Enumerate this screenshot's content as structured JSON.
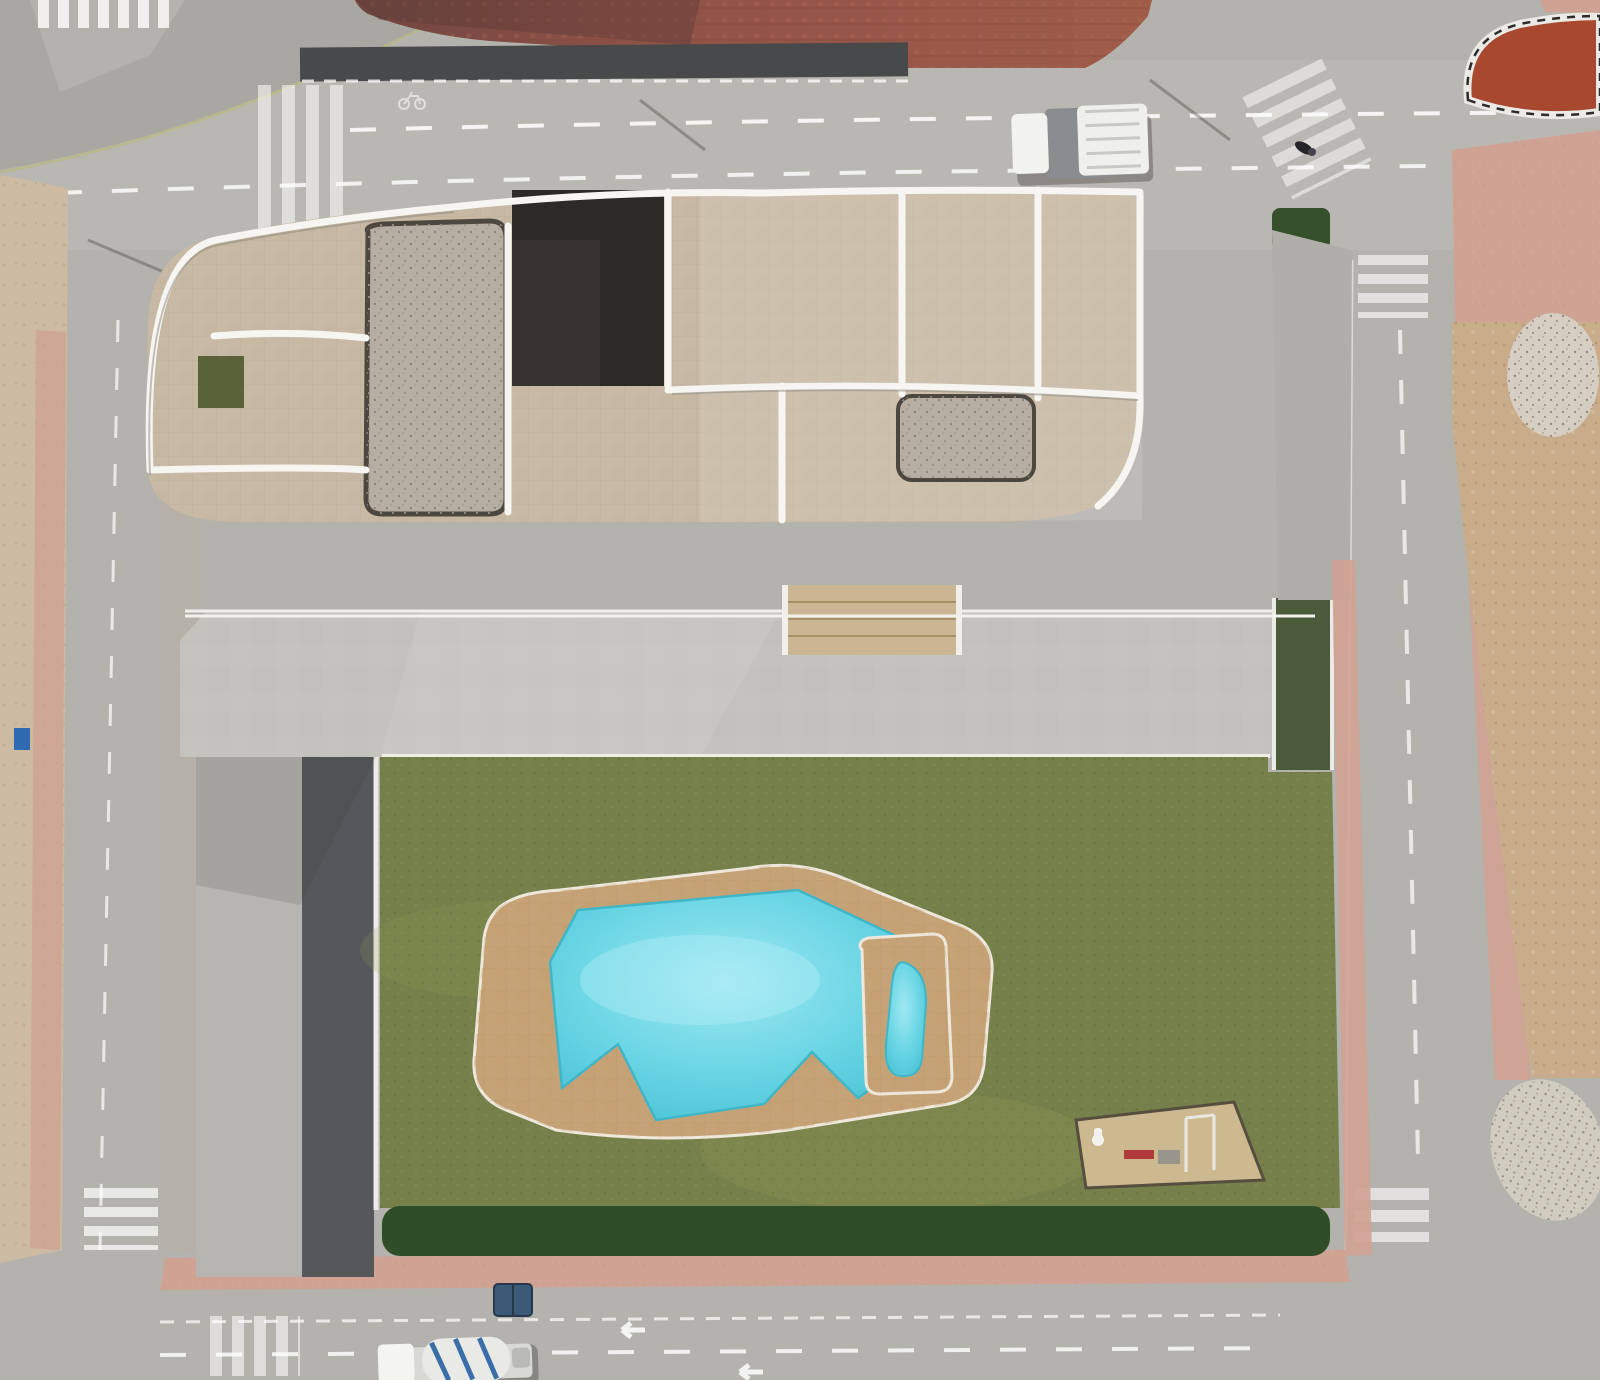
{
  "markings": {
    "stop": "STOP"
  },
  "colors": {
    "road": "#b4b2ad",
    "road_light": "#bdbbb5",
    "sidewalk": "#a9a7a1",
    "plaza": "#99574a",
    "plaza_dark": "#6f4641",
    "island": "#a8492f",
    "pink_sidewalk": "#cfa293",
    "sand": "#cdbaa3",
    "dirt": "#c9ad8b",
    "lawn": "#76804a",
    "turf": "#565d3c",
    "deck": "#c4c2bc",
    "parking_asphalt": "#55575a",
    "building_tile": "#c7b9a3",
    "gravel_roof": "#b6aea2",
    "dark_roof": "#37342f",
    "parapet": "#f6f5f2",
    "pool_water": "#5ecfdf",
    "pool_water_light": "#9fe9f2",
    "pool_deck": "#c6a376",
    "wood": "#a97c50",
    "hedge": "#2f4d26",
    "palm_light": "#c9cf86",
    "palm_dark": "#6b7a3e",
    "stall_line": "#e9e8e4",
    "car_glass": "#20262b"
  },
  "trees": {
    "palms": [
      [
        455,
        790,
        60
      ],
      [
        545,
        772,
        46
      ],
      [
        650,
        806,
        36
      ],
      [
        1080,
        815,
        52
      ],
      [
        1168,
        788,
        40
      ],
      [
        1300,
        858,
        42
      ],
      [
        405,
        935,
        40
      ],
      [
        458,
        1090,
        42
      ],
      [
        398,
        1175,
        36
      ],
      [
        700,
        1208,
        46
      ],
      [
        1135,
        1180,
        44
      ],
      [
        1336,
        1108,
        52
      ],
      [
        1352,
        1190,
        38
      ],
      [
        982,
        1228,
        34
      ],
      [
        845,
        800,
        26
      ],
      [
        995,
        806,
        28
      ],
      [
        58,
        1150,
        34
      ],
      [
        1500,
        172,
        40
      ],
      [
        1352,
        680,
        34
      ],
      [
        1560,
        1288,
        36
      ],
      [
        1035,
        165,
        20
      ],
      [
        905,
        745,
        24
      ]
    ],
    "bushes": [
      [
        402,
        862,
        28
      ],
      [
        368,
        906,
        20
      ],
      [
        530,
        786,
        24
      ],
      [
        614,
        794,
        22
      ],
      [
        852,
        804,
        20
      ],
      [
        968,
        810,
        22
      ],
      [
        1032,
        792,
        24
      ],
      [
        472,
        1122,
        28
      ],
      [
        522,
        1158,
        24
      ],
      [
        446,
        1128,
        26
      ],
      [
        952,
        1122,
        28
      ],
      [
        1002,
        1162,
        24
      ],
      [
        1046,
        1192,
        22
      ],
      [
        1298,
        640,
        18
      ],
      [
        1306,
        732,
        16
      ],
      [
        1298,
        902,
        20
      ],
      [
        1294,
        1002,
        18
      ],
      [
        25,
        652,
        12
      ],
      [
        20,
        782,
        10
      ],
      [
        35,
        1108,
        12
      ],
      [
        1468,
        432,
        8
      ],
      [
        1512,
        522,
        10
      ],
      [
        1480,
        642,
        9
      ],
      [
        1522,
        762,
        11
      ],
      [
        1494,
        902,
        10
      ],
      [
        1540,
        982,
        9
      ],
      [
        1472,
        1010,
        8
      ]
    ]
  },
  "hedge": {
    "x1": 398,
    "x2": 1318,
    "y": 1228,
    "step": 50,
    "r": 25
  },
  "sails": [
    [
      292,
      254,
      66,
      38
    ],
    [
      223,
      445,
      50,
      33
    ],
    [
      586,
      468,
      50,
      40
    ],
    [
      711,
      479,
      52,
      36
    ],
    [
      760,
      290,
      72,
      40
    ],
    [
      870,
      425,
      52,
      44
    ],
    [
      1122,
      256,
      58,
      38
    ],
    [
      1237,
      427,
      60,
      40
    ]
  ],
  "skylights": [
    [
      352,
      404
    ],
    [
      470,
      372
    ],
    [
      601,
      436
    ],
    [
      757,
      408
    ],
    [
      1120,
      366
    ],
    [
      947,
      302
    ]
  ],
  "roof_loungers": [
    [
      398,
      256,
      -12
    ],
    [
      648,
      284,
      8
    ],
    [
      736,
      302,
      14
    ],
    [
      1066,
      240,
      -8
    ],
    [
      1240,
      302,
      10
    ],
    [
      302,
      332,
      -6
    ],
    [
      560,
      470,
      0
    ],
    [
      1000,
      470,
      4
    ]
  ],
  "pergola": {
    "segments": [
      {
        "x1": 185,
        "x2": 782
      },
      {
        "x1": 962,
        "x2": 1312
      }
    ],
    "y": 502,
    "drop": 20,
    "step": 52
  },
  "terraces": {
    "floor_y": 528,
    "floor_h": 82,
    "units": [
      {
        "x": 190,
        "w": 112,
        "floor": "turf",
        "loungers": [
          [
            28,
            30
          ],
          [
            52,
            26
          ]
        ]
      },
      {
        "x": 306,
        "w": 112,
        "floor": "concrete",
        "loungers": []
      },
      {
        "x": 422,
        "w": 112,
        "floor": "turf",
        "loungers": [
          [
            40,
            28
          ],
          [
            62,
            32
          ]
        ]
      },
      {
        "x": 538,
        "w": 112,
        "floor": "turf",
        "loungers": [
          [
            30,
            30
          ],
          [
            56,
            24
          ]
        ]
      },
      {
        "x": 654,
        "w": 124,
        "floor": "turf",
        "loungers": [
          [
            44,
            28
          ],
          [
            66,
            28
          ]
        ]
      },
      {
        "x": 962,
        "w": 112,
        "floor": "turf",
        "loungers": [
          [
            36,
            26
          ],
          [
            58,
            26
          ]
        ]
      },
      {
        "x": 1078,
        "w": 110,
        "floor": "turf",
        "loungers": [
          [
            30,
            28
          ],
          [
            52,
            28
          ]
        ]
      },
      {
        "x": 1192,
        "w": 120,
        "floor": "turf",
        "loungers": [
          [
            40,
            30
          ],
          [
            64,
            30
          ]
        ]
      }
    ]
  },
  "planters": [
    [
      315,
      672,
      182,
      74
    ],
    [
      598,
      672,
      168,
      74
    ],
    [
      1012,
      676,
      170,
      66
    ]
  ],
  "deck_benches": [
    [
      386,
      660,
      30,
      9
    ],
    [
      436,
      661,
      26,
      8
    ],
    [
      614,
      660,
      20,
      8
    ],
    [
      192,
      688,
      55,
      11
    ],
    [
      1197,
      660,
      40,
      9
    ]
  ],
  "wood_path": {
    "x": 888,
    "y0": 766,
    "n": 6,
    "step": 17,
    "w": 58,
    "h": 10
  },
  "garden_benches": {
    "x": 1170,
    "y0": 968,
    "n": 5,
    "step": 21,
    "w": 64,
    "h": 11
  },
  "parking": {
    "x1": 302,
    "x2": 374,
    "lines_y": [
      808,
      905,
      1002,
      1099,
      1196
    ]
  },
  "vehicles": [
    [
      497,
      57,
      58,
      30,
      0,
      "#f4f4f1"
    ],
    [
      577,
      58,
      60,
      30,
      0,
      "#eef0ee"
    ],
    [
      30,
      81,
      60,
      30,
      2,
      "#2c3134"
    ],
    [
      86,
      77,
      52,
      28,
      2,
      "#3f5068"
    ],
    [
      1271,
      155,
      60,
      32,
      -3,
      "#c3c6c9"
    ],
    [
      1239,
      185,
      58,
      30,
      12,
      "#39343f"
    ],
    [
      1399,
      74,
      62,
      32,
      -5,
      "#f2f3f0"
    ],
    [
      828,
      88,
      56,
      28,
      3,
      "#23282c"
    ],
    [
      332,
      932,
      64,
      34,
      0,
      "#f3f4f1"
    ],
    [
      330,
      1032,
      60,
      34,
      0,
      "#3f4347"
    ],
    [
      329,
      1134,
      58,
      32,
      0,
      "#45484c"
    ],
    [
      328,
      1302,
      64,
      34,
      12,
      "#f2f2ef"
    ],
    [
      1298,
      726,
      60,
      28,
      90,
      "#eff0ed"
    ],
    [
      585,
      1295,
      56,
      30,
      0,
      "#33383c"
    ],
    [
      660,
      1292,
      56,
      30,
      0,
      "#c9cbc8"
    ],
    [
      741,
      1290,
      54,
      30,
      0,
      "#3e4246"
    ],
    [
      905,
      1288,
      56,
      30,
      -2,
      "#2f3337"
    ]
  ],
  "pool": {
    "parasol": {
      "x": 672,
      "y": 922,
      "r": 19
    },
    "loungers": [
      [
        531,
        972,
        83,
        "lounger"
      ],
      [
        534,
        1016,
        80,
        "lounger"
      ],
      [
        538,
        1058,
        78,
        "lounger"
      ],
      [
        700,
        921,
        8,
        "chair"
      ],
      [
        722,
        928,
        10,
        "chair"
      ],
      [
        746,
        918,
        4,
        "chair"
      ],
      [
        818,
        1022,
        0,
        "pillow"
      ],
      [
        828,
        1056,
        0,
        "pillow"
      ],
      [
        641,
        1076,
        0,
        "pillow"
      ],
      [
        679,
        1088,
        0,
        "pillow"
      ],
      [
        714,
        1095,
        0,
        "pillow"
      ],
      [
        884,
        1080,
        0,
        "pillow"
      ]
    ]
  },
  "shadows": [
    [
      120,
      268,
      70,
      22,
      -18,
      0.25
    ],
    [
      90,
      672,
      60,
      18,
      -15,
      0.22
    ],
    [
      80,
      1035,
      55,
      16,
      -15,
      0.2
    ],
    [
      1392,
      700,
      70,
      20,
      -20,
      0.22
    ],
    [
      1420,
      1085,
      80,
      22,
      -24,
      0.22
    ],
    [
      1460,
      228,
      64,
      18,
      -28,
      0.25
    ],
    [
      655,
      150,
      90,
      14,
      -4,
      0.15
    ],
    [
      230,
      118,
      80,
      14,
      -8,
      0.18
    ],
    [
      1180,
      128,
      60,
      12,
      -6,
      0.16
    ],
    [
      330,
      700,
      170,
      46,
      -6,
      0.13
    ],
    [
      585,
      1045,
      130,
      55,
      -28,
      0.2
    ],
    [
      880,
      988,
      150,
      45,
      -25,
      0.16
    ],
    [
      1120,
      900,
      120,
      40,
      -30,
      0.16
    ],
    [
      480,
      862,
      90,
      40,
      -25,
      0.18
    ],
    [
      760,
      1162,
      110,
      38,
      -18,
      0.13
    ],
    [
      1230,
      1082,
      100,
      45,
      -30,
      0.16
    ],
    [
      940,
      760,
      120,
      30,
      -15,
      0.14
    ]
  ],
  "people": [
    [
      403,
      1297
    ],
    [
      413,
      1303
    ],
    [
      422,
      1296
    ],
    [
      1303,
      146
    ],
    [
      1312,
      150
    ]
  ],
  "plaza_benches": [
    [
      380,
      20,
      44,
      10
    ],
    [
      975,
      38,
      48,
      10
    ],
    [
      1040,
      47,
      30,
      8
    ]
  ]
}
